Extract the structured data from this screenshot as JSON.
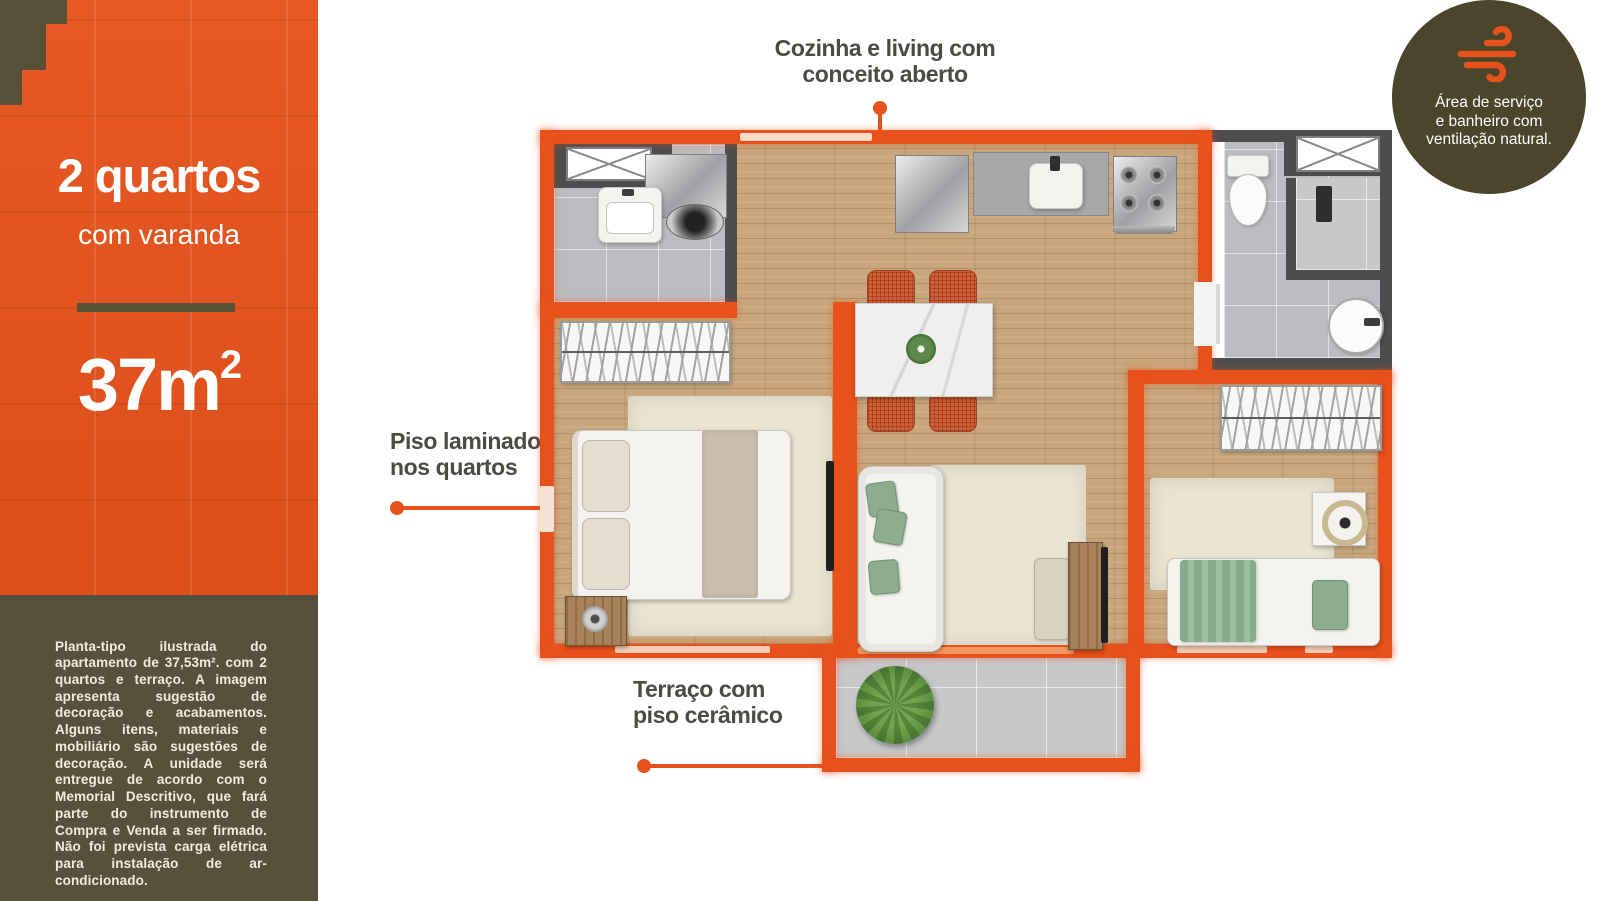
{
  "colors": {
    "accent_orange": "#e5521c",
    "wall_orange": "#e8511b",
    "olive_panel": "#56513a",
    "badge_olive": "#4a452b",
    "annotation_text": "#4b4b43",
    "wall_dark": "#4d4d4f",
    "wood_floor": "#c9a77d",
    "tile_floor": "#bcbdc0"
  },
  "sidebar": {
    "title": "2 quartos",
    "subtitle": "com varanda",
    "area_value": "37m",
    "area_exponent": "2",
    "disclaimer": "Planta-tipo ilustrada do apartamento de 37,53m². com 2 quartos e terraço. A imagem apresenta sugestão de decoração e acabamentos. Alguns itens, materiais e mobiliário são sugestões de decoração. A unidade será entregue de acordo com o Memorial Descritivo, que fará parte do instrumento de Compra e Venda a ser firmado. Não foi prevista carga elétrica para instalação de ar-condicionado."
  },
  "annotations": {
    "kitchen": {
      "line1": "Cozinha e living com",
      "line2": "conceito aberto"
    },
    "laminate": {
      "line1": "Piso laminado",
      "line2": "nos quartos"
    },
    "terrace": {
      "line1": "Terraço com",
      "line2": "piso cerâmico"
    }
  },
  "badge": {
    "icon": "wind-icon",
    "line1": "Área de serviço",
    "line2": "e banheiro com",
    "line3": "ventilação natural."
  }
}
